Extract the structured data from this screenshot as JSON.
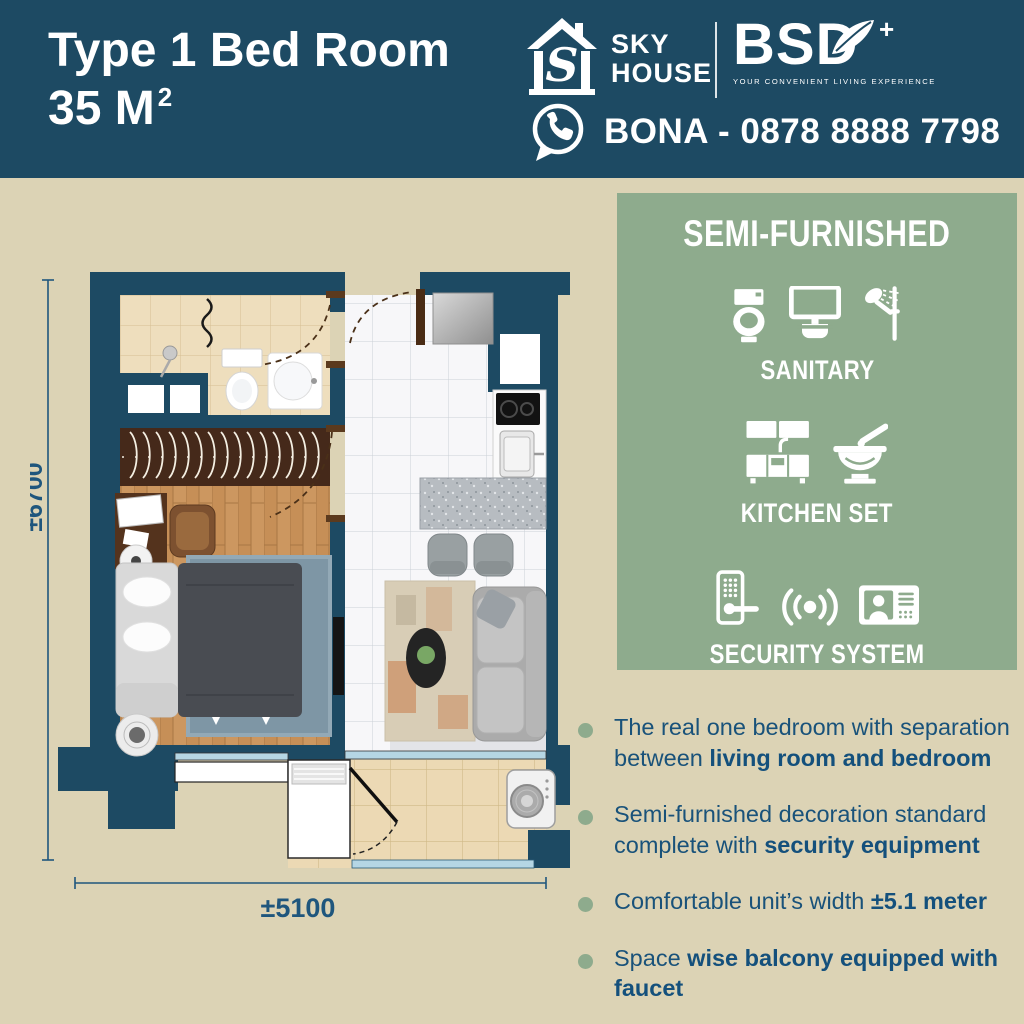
{
  "banner": {
    "title_line1": "Type 1 Bed Room",
    "title_area": "35 M",
    "title_sup": "2",
    "brand": {
      "logo_letter": "S",
      "sky_top": "SKY",
      "sky_bottom": "HOUSE",
      "bsd_name": "BSD",
      "bsd_plus": "+",
      "tagline": "YOUR CONVENIENT LIVING EXPERIENCE"
    },
    "contact_label": "BONA -  0878 8888 7798"
  },
  "semi_panel": {
    "title": "SEMI-FURNISHED",
    "sections": [
      {
        "label": "SANITARY",
        "icons": [
          "toilet-icon",
          "wash-basin-icon",
          "shower-icon"
        ]
      },
      {
        "label": "KITCHEN SET",
        "icons": [
          "kitchen-cabinet-icon",
          "mortar-pestle-icon"
        ]
      },
      {
        "label": "SECURITY SYSTEM",
        "icons": [
          "door-lock-icon",
          "alarm-signal-icon",
          "video-intercom-icon"
        ]
      }
    ]
  },
  "features": [
    {
      "pre": "The real one bedroom with separation between ",
      "bold": "living room and bedroom",
      "post": ""
    },
    {
      "pre": "Semi-furnished decoration standard complete with ",
      "bold": "security equipment",
      "post": ""
    },
    {
      "pre": "Comfortable unit’s width ",
      "bold": "±5.1 meter",
      "post": ""
    },
    {
      "pre": "Space ",
      "bold": "wise balcony equipped with faucet",
      "post": ""
    }
  ],
  "floorplan": {
    "height_dim": "±6700",
    "width_dim": "±5100"
  },
  "colors": {
    "banner_blue": "#1d4a63",
    "background_beige": "#dcd3b5",
    "panel_green": "#8eab8d",
    "text_blue": "#19527a",
    "wall_blue": "#1d4a63"
  }
}
